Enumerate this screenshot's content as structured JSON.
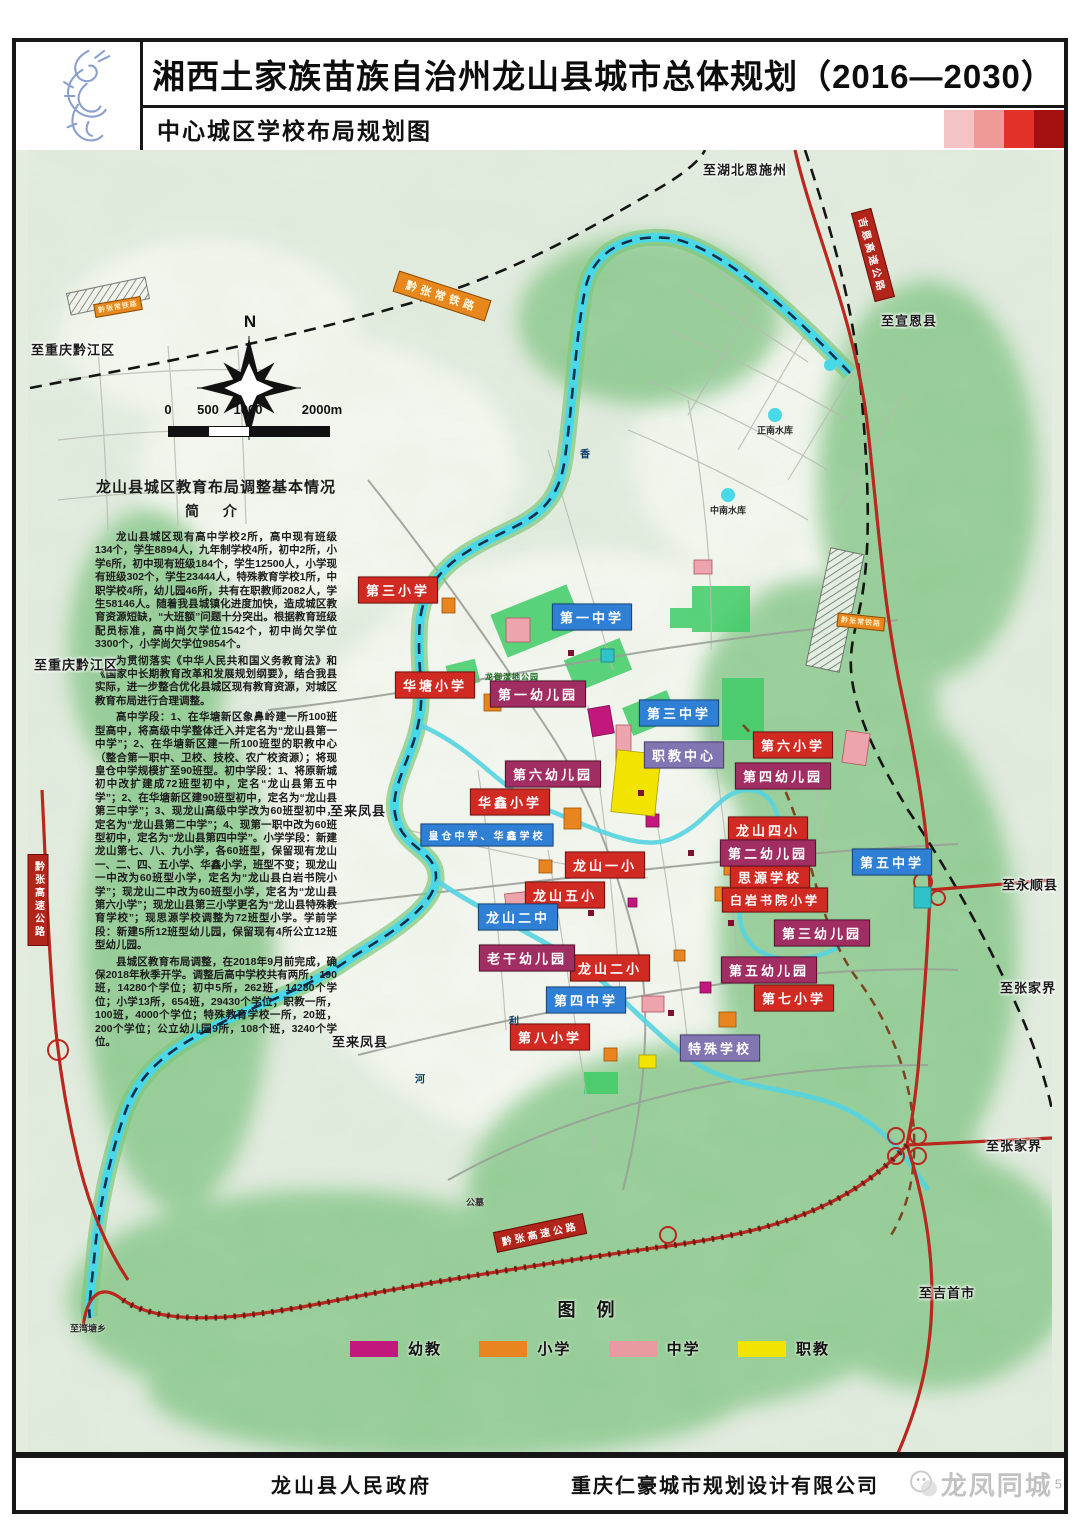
{
  "header": {
    "title": "湘西土家族苗族自治州龙山县城市总体规划（2016—2030）",
    "subtitle": "中心城区学校布局规划图",
    "logo": "dragon-seal",
    "gradient": [
      "#f3c3c6",
      "#ef9a97",
      "#e23128",
      "#a40f0f"
    ]
  },
  "intro": {
    "heading": "龙山县城区教育布局调整基本情况",
    "subheading": "简  介",
    "paragraphs": [
      "龙山县城区现有高中学校2所，高中现有班级134个，学生8894人，九年制学校4所，初中2所，小学6所，初中现有班级184个，学生12500人，小学现有班级302个，学生23444人，特殊教育学校1所，中职学校4所，幼儿园46所，共有在职教师2082人，学生58146人。随着我县城镇化进度加快，造成城区教育资源短缺，“大班额”问题十分突出。根据教育班级配员标准，高中尚欠学位1542个，初中尚欠学位3300个，小学尚欠学位9854个。",
      "为贯彻落实《中华人民共和国义务教育法》和《国家中长期教育改革和发展规划纲要》，结合我县实际，进一步整合优化县城区现有教育资源，对城区教育布局进行合理调整。",
      "高中学段：1、在华塘新区象鼻岭建一所100班型高中，将高级中学整体迁入并定名为“龙山县第一中学”；2、在华塘新区建一所100班型的职教中心（整合第一职中、卫校、技校、农广校资源）；将现皇仓中学规模扩至90班型。初中学段：1、将原新城初中改扩建成72班型初中，定名“龙山县第五中学”；2、在华塘新区建90班型初中，定名为“龙山县第三中学”；3、现龙山高级中学改为60班型初中，定名为“龙山县第二中学”；4、现第一职中改为60班型初中，定名为“龙山县第四中学”。小学学段：新建龙山第七、八、九小学，各60班型，保留现有龙山一、二、四、五小学、华鑫小学，班型不变；现龙山一中改为60班型小学，定名为“龙山县白岩书院小学”；现龙山二中改为60班型小学，定名为“龙山县第六小学”；现龙山县第三小学更名为“龙山县特殊教育学校”；现思源学校调整为72班型小学。学前学段：新建5所12班型幼儿园，保留现有4所公立12班型幼儿园。",
      "县城区教育布局调整，在2018年9月前完成，确保2018年秋季开学。调整后高中学校共有两所，190班，14280个学位；初中5所，262班，14280个学位；小学13所，654班，29430个学位；职教一所，100班，4000个学位；特殊教育学校一所，20班，200个学位；公立幼儿园9所，108个班，3240个学位。"
    ]
  },
  "map": {
    "compass": "N",
    "scale": {
      "ticks": [
        {
          "t": "0",
          "x": 8
        },
        {
          "t": "500",
          "x": 48
        },
        {
          "t": "1000",
          "x": 88
        },
        {
          "t": "2000m",
          "x": 162
        }
      ]
    },
    "labels": [
      {
        "t": "第三小学",
        "x": 370,
        "y": 440,
        "c": "ps"
      },
      {
        "t": "华塘小学",
        "x": 407,
        "y": 535,
        "c": "ps"
      },
      {
        "t": "华鑫小学",
        "x": 482,
        "y": 652,
        "c": "ps"
      },
      {
        "t": "龙山一小",
        "x": 577,
        "y": 715,
        "c": "ps"
      },
      {
        "t": "龙山五小",
        "x": 537,
        "y": 745,
        "c": "ps"
      },
      {
        "t": "龙山二小",
        "x": 582,
        "y": 818,
        "c": "ps"
      },
      {
        "t": "第八小学",
        "x": 522,
        "y": 887,
        "c": "ps"
      },
      {
        "t": "第六小学",
        "x": 765,
        "y": 595,
        "c": "ps"
      },
      {
        "t": "龙山四小",
        "x": 740,
        "y": 680,
        "c": "ps"
      },
      {
        "t": "思源学校",
        "x": 742,
        "y": 727,
        "c": "ps"
      },
      {
        "t": "白岩书院小学",
        "x": 747,
        "y": 750,
        "c": "ps",
        "fs": 12
      },
      {
        "t": "第七小学",
        "x": 766,
        "y": 848,
        "c": "ps"
      },
      {
        "t": "第一中学",
        "x": 564,
        "y": 467,
        "c": "ms"
      },
      {
        "t": "第三中学",
        "x": 651,
        "y": 563,
        "c": "ms"
      },
      {
        "t": "第五中学",
        "x": 864,
        "y": 712,
        "c": "ms"
      },
      {
        "t": "龙山二中",
        "x": 490,
        "y": 767,
        "c": "ms"
      },
      {
        "t": "第四中学",
        "x": 558,
        "y": 850,
        "c": "ms"
      },
      {
        "t": "皇仓中学、华鑫学校",
        "x": 459,
        "y": 685,
        "c": "ms",
        "fs": 10
      },
      {
        "t": "第一幼儿园",
        "x": 510,
        "y": 544,
        "c": "kg"
      },
      {
        "t": "第六幼儿园",
        "x": 525,
        "y": 624,
        "c": "kg"
      },
      {
        "t": "第四幼儿园",
        "x": 755,
        "y": 626,
        "c": "kg"
      },
      {
        "t": "第二幼儿园",
        "x": 740,
        "y": 703,
        "c": "kg"
      },
      {
        "t": "第三幼儿园",
        "x": 794,
        "y": 783,
        "c": "kg"
      },
      {
        "t": "第五幼儿园",
        "x": 741,
        "y": 820,
        "c": "kg"
      },
      {
        "t": "老干幼儿园",
        "x": 499,
        "y": 808,
        "c": "kg"
      },
      {
        "t": "职教中心",
        "x": 656,
        "y": 605,
        "c": "voc"
      },
      {
        "t": "特殊学校",
        "x": 692,
        "y": 898,
        "c": "voc"
      },
      {
        "t": "至湖北恩施州",
        "x": 717,
        "y": 19,
        "c": "dir"
      },
      {
        "t": "至重庆黔江区",
        "x": 45,
        "y": 199,
        "c": "dir"
      },
      {
        "t": "至重庆黔江区",
        "x": 48,
        "y": 514,
        "c": "dir"
      },
      {
        "t": "至来凤县",
        "x": 330,
        "y": 660,
        "c": "dir"
      },
      {
        "t": "至来凤县",
        "x": 332,
        "y": 891,
        "c": "dir"
      },
      {
        "t": "至宣恩县",
        "x": 881,
        "y": 170,
        "c": "dir"
      },
      {
        "t": "至永顺县",
        "x": 1002,
        "y": 734,
        "c": "dir"
      },
      {
        "t": "至张家界",
        "x": 1000,
        "y": 837,
        "c": "dir"
      },
      {
        "t": "至张家界",
        "x": 986,
        "y": 995,
        "c": "dir"
      },
      {
        "t": "至吉首市",
        "x": 919,
        "y": 1142,
        "c": "dir"
      },
      {
        "t": "至湾塘乡",
        "x": 60,
        "y": 1178,
        "c": "tiny"
      },
      {
        "t": "公墓",
        "x": 447,
        "y": 1052,
        "c": "tiny"
      },
      {
        "t": "正南水库",
        "x": 747,
        "y": 280,
        "c": "tiny"
      },
      {
        "t": "中南水库",
        "x": 700,
        "y": 360,
        "c": "tiny"
      },
      {
        "t": "龙御湿地公园",
        "x": 484,
        "y": 527,
        "c": "park"
      },
      {
        "t": "香",
        "x": 557,
        "y": 303,
        "c": "riv"
      },
      {
        "t": "利",
        "x": 486,
        "y": 870,
        "c": "riv"
      },
      {
        "t": "河",
        "x": 392,
        "y": 928,
        "c": "riv"
      },
      {
        "t": "黔张常铁路",
        "x": 414,
        "y": 146,
        "r": 18,
        "c": "rail"
      },
      {
        "t": "黔张常铁路",
        "x": 90,
        "y": 157,
        "r": -10,
        "c": "railsm"
      },
      {
        "t": "黔张常铁路",
        "x": 833,
        "y": 472,
        "r": 6,
        "c": "railsm"
      },
      {
        "t": "黔张高速公路",
        "x": 10,
        "y": 750,
        "c": "hwyv"
      },
      {
        "t": "黔张高速公路",
        "x": 512,
        "y": 1083,
        "r": -12,
        "c": "hwy"
      },
      {
        "t": "吉恩高速公路",
        "x": 845,
        "y": 105,
        "r": 75,
        "c": "hwy"
      }
    ],
    "legend": {
      "title": "图 例",
      "items": [
        {
          "label": "幼教",
          "color": "#c2187e"
        },
        {
          "label": "小学",
          "color": "#e8851e"
        },
        {
          "label": "中学",
          "color": "#e89aa2"
        },
        {
          "label": "职教",
          "color": "#f2e400"
        }
      ]
    }
  },
  "footer": {
    "left": "龙山县人民政府",
    "right": "重庆仁豪城市规划设计有限公司",
    "watermark": "龙凤同城",
    "page": "5"
  }
}
